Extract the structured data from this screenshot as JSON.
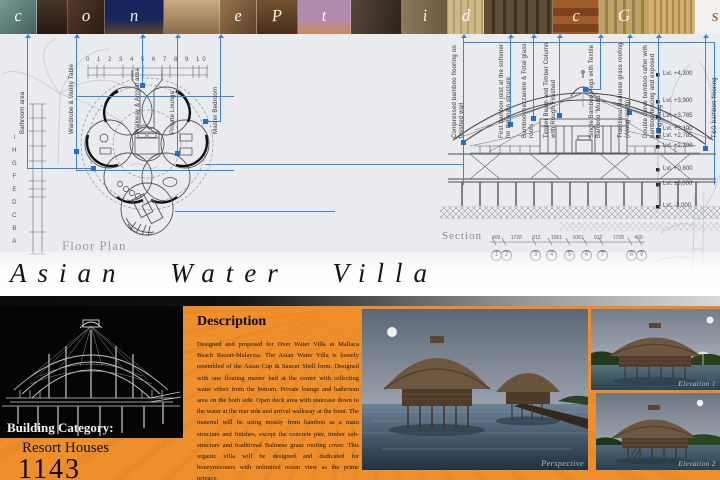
{
  "board": {
    "title": "Asian Water Villa"
  },
  "colors": {
    "orange": "#ef8f2b",
    "annotation_blue": "#3b85d8",
    "drawing_bg": "#e9ebee",
    "panel_black": "#050505"
  },
  "photo_strip": {
    "word": "concept designs",
    "letters": [
      "c",
      "",
      "o",
      "n",
      "",
      "e",
      "P",
      "t",
      "",
      "i",
      "d",
      "",
      "c",
      "G",
      "",
      "s"
    ]
  },
  "plan": {
    "label": "Floor Plan",
    "grid_letters_col": "I\nH\nG\nF\nE\nD\nC\nB\nA",
    "grid_numbers_row": "0 1 2    3  4    5  6  7    8 9 10",
    "annotations": [
      "Bathroom area",
      "Wardrobe & Vanity Table",
      "Walkway & Arrival area",
      "Private Lounge",
      "Master Bedroom"
    ]
  },
  "section": {
    "label": "Section",
    "annotations": [
      "Compressed bamboo flooring on finished wall",
      "First bamboo joist at the softener for the main structure",
      "Bamboo mezzanine & Total glass roofs",
      "Timber Beam and Timber Column with Rough Finished",
      "Single Bamboo Pegs with Textile Bamboo 'Murid'",
      "Traditional Balinese grass roofing (Alang-alang)",
      "Double curve bamboo rafter with bamboo bracing and exposed alang-alang",
      "T&G bamboo flooring"
    ],
    "levels": [
      "Lvl. +4,300",
      "Lvl. +3,900",
      "Lvl. +3,785",
      "Lvl. +3,100",
      "Lvl. +2,785",
      "Lvl. +2,300",
      "Lvl. +0,800",
      "Lvl. ±0,000",
      "Lvl. -2,000"
    ],
    "grid": [
      "1",
      "2",
      "3",
      "4",
      "5",
      "6",
      "7",
      "8",
      "9"
    ],
    "dims_row": "400  1728  912  1061  1061  912  1728  400"
  },
  "description": {
    "heading": "Description",
    "body": "Designed and proposed for Over Water Villa at Mallaca Beach Resort-Malaysia. The Asian Water Villa is loosely resembled of the Asian Cup & Saucer Shell form. Designed with one floating master bed at the center with reflecting water effect from the bottom. Private lounge and bathroom area on the both side. Open deck area with staircase down to the water at the rear side and arrival walkway at the front. The material will be using mostly from bamboo as a main structure and finishes, except the concrete pier, timber sub-structure and traditional Balinese grass roofing cover. This organic villa will be designed and dedicated for honeymooners with unlimited ocean view as the prime privacy."
  },
  "category": {
    "label": "Building Category:",
    "value": "Resort Houses",
    "number": "1143"
  },
  "renders": {
    "perspective_label": "Perspective",
    "elevation1_label": "Elevation 1",
    "elevation2_label": "Elevation 2"
  }
}
